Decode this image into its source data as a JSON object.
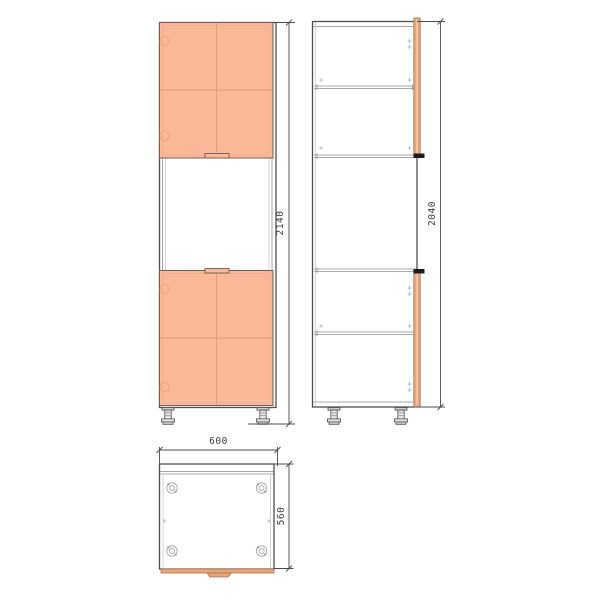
{
  "drawing": {
    "views": {
      "front": {
        "height_label": "2140"
      },
      "side": {
        "height_label": "2040"
      },
      "plan": {
        "width_label": "600",
        "depth_label": "560"
      }
    },
    "colors": {
      "door_fill": "#FCB99A",
      "door_border": "#6E5E52",
      "door_line": "#DB9C7B",
      "edge_fill": "#E9A77C",
      "edge_border": "#A5704B",
      "edge_highlight": "#F6C9A4",
      "outline": "#4D4D4D",
      "detail": "#9AA0A6",
      "dim": "#4A4A4A",
      "text": "#3C3C3C"
    }
  }
}
